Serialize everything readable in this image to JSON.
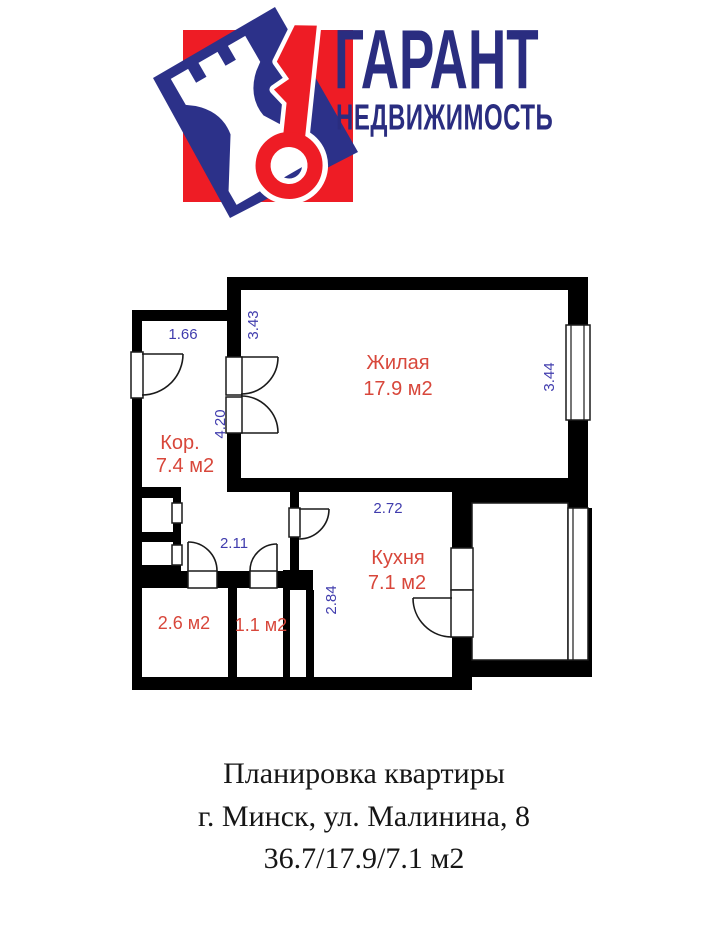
{
  "logo": {
    "title": "ГАРАНТ",
    "subtitle": "НЕДВИЖИМОСТЬ"
  },
  "floor_plan": {
    "rooms": {
      "living": {
        "name": "Жилая",
        "area": "17.9 м2"
      },
      "corridor": {
        "name": "Кор.",
        "area": "7.4 м2"
      },
      "kitchen": {
        "name": "Кухня",
        "area": "7.1 м2"
      },
      "bathroom": {
        "area": "2.6 м2"
      },
      "toilet": {
        "area": "1.1 м2"
      }
    },
    "dimensions": {
      "corridor_width": "1.66",
      "living_left": "3.43",
      "corridor_height": "4.20",
      "living_right": "3.44",
      "kitchen_top": "2.72",
      "kitchen_left": "2.84",
      "hallway_width": "2.11"
    }
  },
  "caption": {
    "line1": "Планировка квартиры",
    "line2": "г. Минск, ул. Малинина, 8",
    "line3": "36.7/17.9/7.1 м2"
  },
  "colors": {
    "wall": "#000000",
    "dimension_text": "#403cad",
    "room_text": "#d8473b",
    "logo_red": "#ee1c25",
    "logo_blue": "#2c3189",
    "logo_text": "#2a2d80",
    "caption_text": "#161616"
  }
}
